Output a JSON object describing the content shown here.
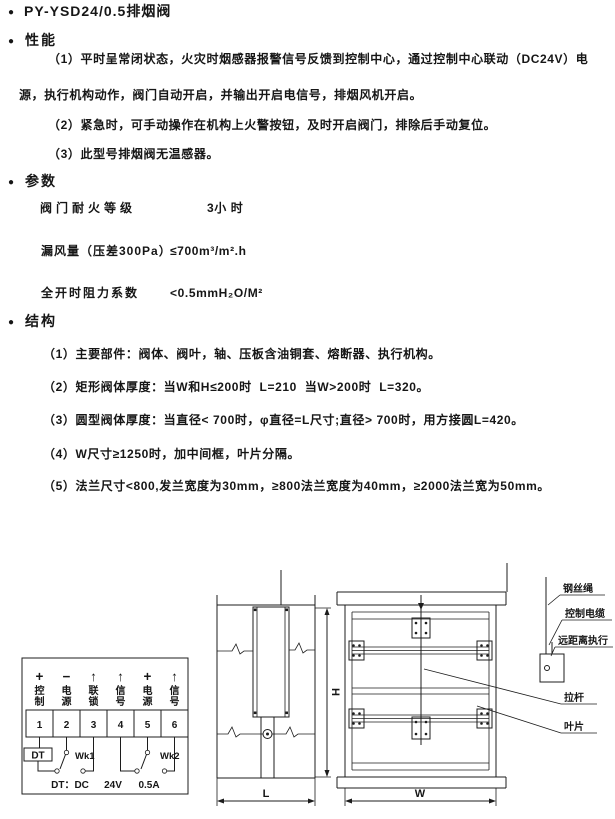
{
  "icons": {
    "bullet": "●"
  },
  "page": {
    "title": "PY-YSD24/0.5排烟阀"
  },
  "performance": {
    "heading": "性能",
    "item1_line1": "（1）平时呈常闭状态，火灾时烟感器报警信号反馈到控制中心，通过控制中心联动（DC24V）电",
    "item1_line2": "源，执行机构动作，阀门自动开启，并输出开启电信号，排烟风机开启。",
    "item2": "（2）紧急时，可手动操作在机构上火警按钮，及时开启阀门，排除后手动复位。",
    "item3": "（3）此型号排烟阀无温感器。"
  },
  "parameters": {
    "heading": "参数",
    "rows": [
      {
        "label": "阀门耐火等级",
        "value": "3小 时"
      },
      {
        "label": "漏风量（压差300Pa）",
        "value": "≤700m³/m².h"
      },
      {
        "label": "全开时阻力系数",
        "value": "<0.5mmH₂O/M²"
      }
    ]
  },
  "structure": {
    "heading": "结构",
    "items": [
      "（1）主要部件：阀体、阀叶，轴、压板含油铜套、熔断器、执行机构。",
      "（2）矩形阀体厚度：当W和H≤200时  L=210  当W>200时  L=320。",
      "（3）圆型阀体厚度：当直径< 700时，φ直径=L尺寸;直径> 700时，用方接圆L=420。",
      "（4）W尺寸≥1250时，加中间框，叶片分隔。",
      "（5）法兰尺寸<800,发兰宽度为30mm，≥800法兰宽度为40mm，≥2000法兰宽为50mm。"
    ]
  },
  "wiring": {
    "symbols": [
      "+",
      "−",
      "↑",
      "↑",
      "+",
      "↑"
    ],
    "labels": [
      [
        "控",
        "制"
      ],
      [
        "电",
        "源"
      ],
      [
        "联",
        "锁"
      ],
      [
        "信",
        "号"
      ],
      [
        "电",
        "源"
      ],
      [
        "信",
        "号"
      ]
    ],
    "terminals": [
      "1",
      "2",
      "3",
      "4",
      "5",
      "6"
    ],
    "dt_box": "DT",
    "wk1": "Wk1",
    "wk2": "Wk2",
    "caption_dt": "DT：DC",
    "caption_24v": "24V",
    "caption_05a": "0.5A"
  },
  "dimensions": {
    "h": "H",
    "l": "L",
    "w": "W"
  },
  "callouts": {
    "wire_rope": "钢丝绳",
    "control_cable": "控制电缆",
    "remote_actuator": "远距离执行",
    "pull_rod": "拉杆",
    "blade": "叶片"
  }
}
